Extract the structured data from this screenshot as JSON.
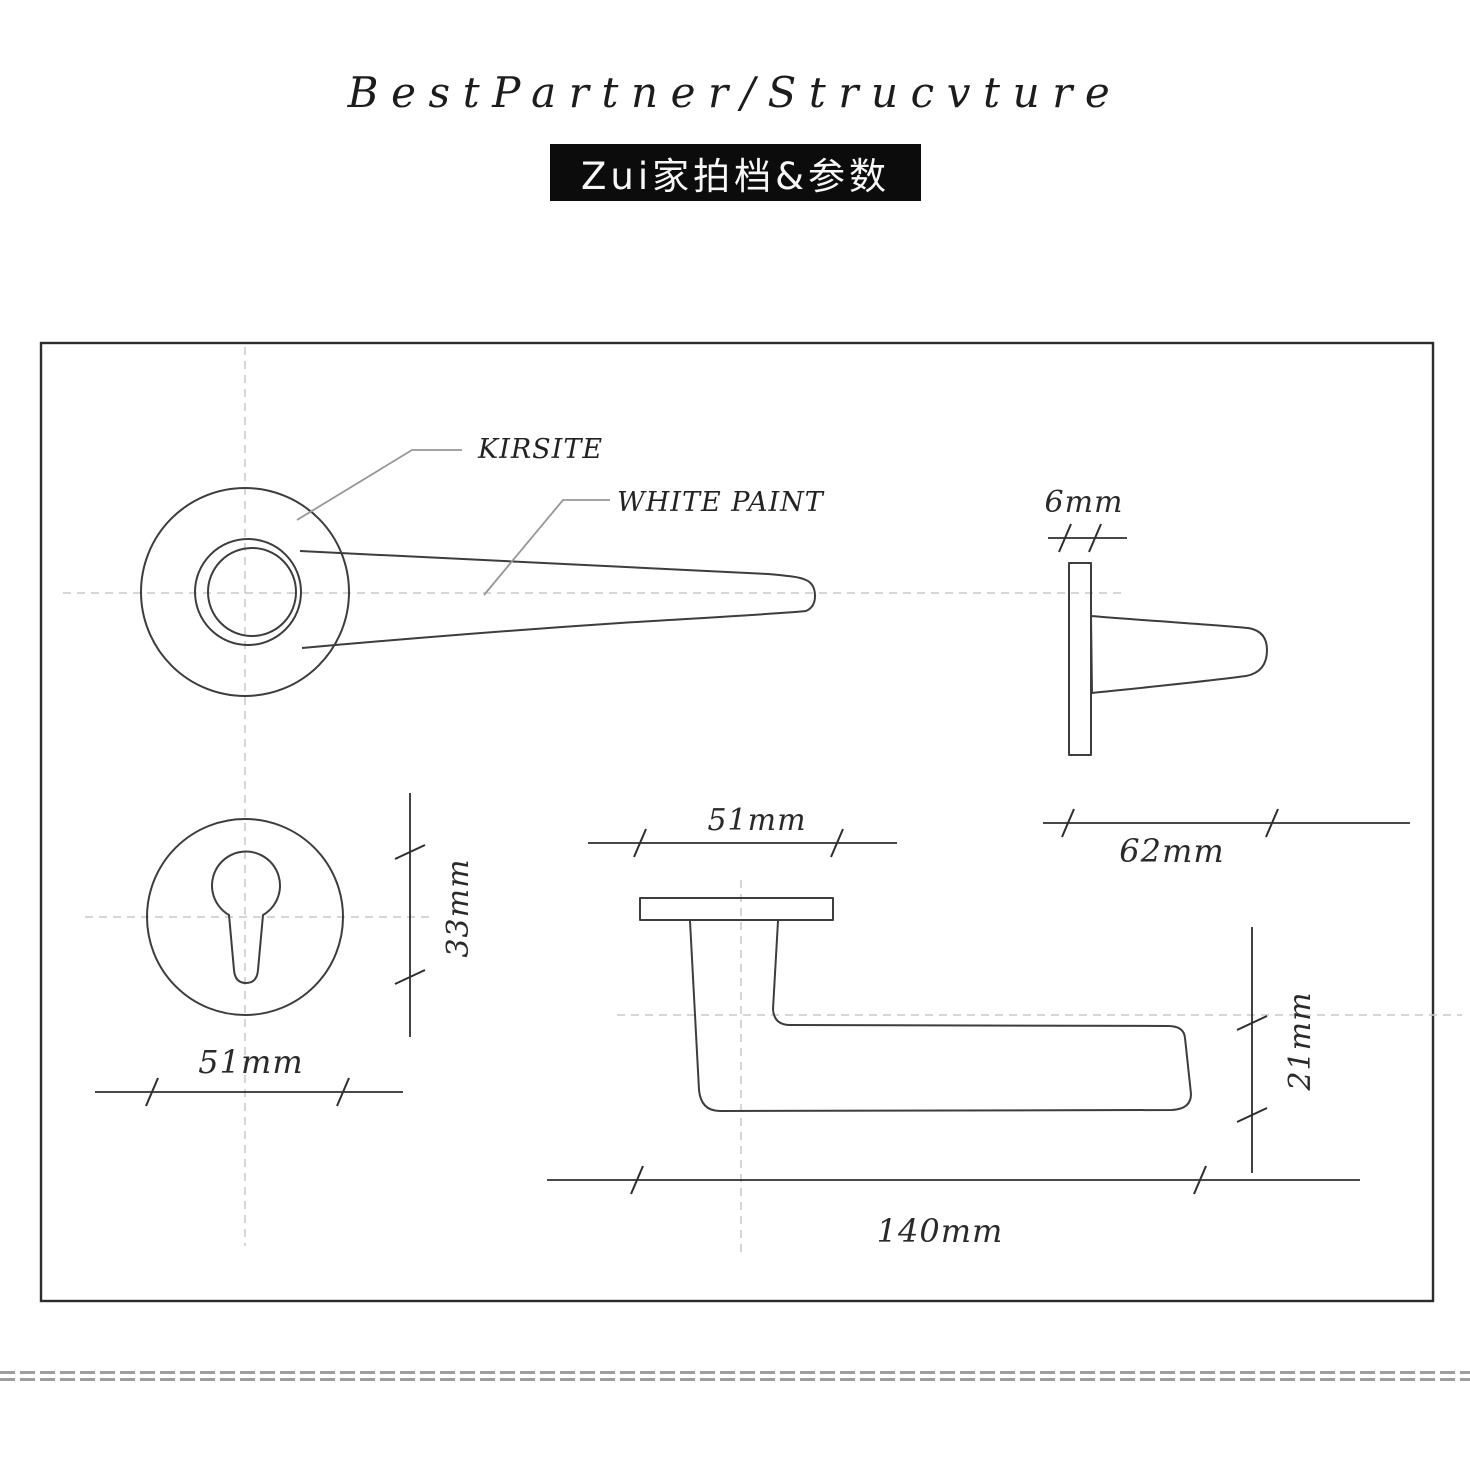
{
  "page": {
    "background": "#ffffff"
  },
  "header": {
    "title": "BestPartner/Strucvture",
    "badge": "Zui家拍档&参数"
  },
  "drawing": {
    "callouts": {
      "material": "KIRSITE",
      "finish": "WHITE PAINT"
    },
    "dimensions": {
      "rose_thickness": "6mm",
      "handle_projection": "62mm",
      "escutcheon_diameter": "51mm",
      "keyhole_height": "33mm",
      "rose_width": "51mm",
      "lever_depth": "21mm",
      "lever_length": "140mm"
    },
    "colors": {
      "outline": "#3d3d3d",
      "border": "#2b2b2b",
      "dimension": "#2e2e2e",
      "centerline": "#c9c9c9",
      "leader": "#979797",
      "badge_bg": "#0c0c0c",
      "badge_text": "#f7f7f7",
      "separator": "#9e9e9e"
    }
  }
}
